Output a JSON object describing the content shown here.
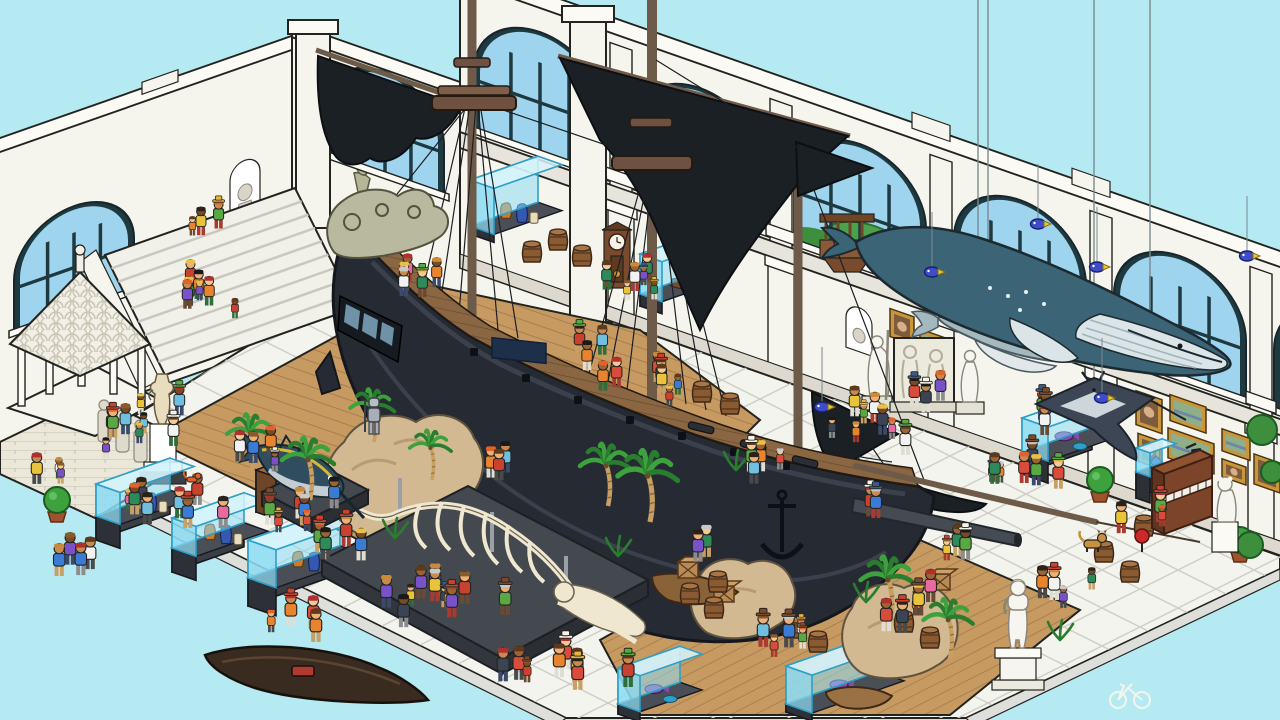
{
  "meta": {
    "app": "isometric-hidden-object-museum-scene",
    "description": "Isometric cartoon museum hall crowded with visitors: a large dark pirate galleon on a wooden floor, a hanging humpback whale with calf and manta ray, a whale skeleton, a mounted marlin, glass display vitrines, classical statues, a piano, palm trees and rocks.",
    "canvas": {
      "w": 1280,
      "h": 720
    }
  },
  "palette": {
    "sky": "#b5eaf3",
    "wall": "#f5f4ed",
    "wallShade": "#e7e5db",
    "wallLine": "#23231f",
    "frame": "#1e3a40",
    "glass": "#9fd4ee",
    "tile": "#f4f4ef",
    "tileLine": "#cdcdc4",
    "tileSkirt": "#dededa",
    "woodFloor": "#c79a62",
    "woodLine": "#a07748",
    "deck": "#8a6742",
    "deckLine": "#5f462d",
    "hull": "#262b33",
    "hullLight": "#3a414c",
    "hullDark": "#14171c",
    "sail": "#1b2025",
    "mast": "#6e5a49",
    "whale": "#3b6477",
    "whaleBelly": "#dbe4e6",
    "calf": "#a3b8bf",
    "bone": "#f0e7d1",
    "boneLine": "#6a614e",
    "rock": "#d2b992",
    "rockShade": "#b99a72",
    "palm": "#3da23d",
    "palmDark": "#2a7d2f",
    "trunk": "#c9a062",
    "caseGlass": "#8ddcf4",
    "caseEdge": "#2e9fc6",
    "caseBase": "#3a3e45",
    "gold": "#c9973a",
    "piano": "#7c4429",
    "statue": "#f6f5ef",
    "barrel": "#8a5a33",
    "barrelTop": "#a97547",
    "crate": "#b98a55"
  },
  "scene": {
    "objects": [
      "pirate-galleon",
      "humpback-whale-model",
      "whale-calf-model",
      "manta-ray-model",
      "whale-skeleton",
      "marlin-mount",
      "grand-staircase",
      "stone-pavilion",
      "display-vitrines",
      "aquarium-tanks",
      "gallery-paintings",
      "upright-piano",
      "david-statue",
      "classical-statues",
      "grandfather-clock",
      "suit-of-armor",
      "canoe",
      "rowboat",
      "palm-trees",
      "rocks",
      "visitors",
      "dog",
      "cat",
      "bicycle"
    ],
    "walls": {
      "right_windows": [
        {
          "x": 474,
          "bush": false
        },
        {
          "x": 634,
          "bush": false
        },
        {
          "x": 794,
          "bush": true
        },
        {
          "x": 954,
          "bush": true
        },
        {
          "x": 1114,
          "bush": false
        },
        {
          "x": 1274,
          "bush": false
        }
      ],
      "right_window_size": {
        "y": 48,
        "w": 132,
        "h": 122
      },
      "left_windows": [
        {
          "x": 14,
          "y": 232,
          "w": 120,
          "h": 106
        }
      ],
      "mid_windows": [
        {
          "x": 326,
          "y": 2,
          "w": 118,
          "h": 104
        }
      ],
      "pilasters_x": [
        610,
        770,
        930,
        1090,
        1250
      ],
      "paintings_right": [
        {
          "x": 1136,
          "y": 198,
          "w": 26,
          "h": 34,
          "k": "p"
        },
        {
          "x": 1170,
          "y": 190,
          "w": 36,
          "h": 26,
          "k": "l"
        },
        {
          "x": 1138,
          "y": 240,
          "w": 22,
          "h": 28,
          "k": "p"
        },
        {
          "x": 1168,
          "y": 224,
          "w": 46,
          "h": 30,
          "k": "l"
        },
        {
          "x": 1222,
          "y": 206,
          "w": 28,
          "h": 22,
          "k": "l"
        },
        {
          "x": 1222,
          "y": 236,
          "w": 24,
          "h": 18,
          "k": "p"
        },
        {
          "x": 1254,
          "y": 220,
          "w": 26,
          "h": 30,
          "k": "p"
        }
      ],
      "paintings_mid": [
        {
          "x": 890,
          "y": 202,
          "w": 24,
          "h": 28,
          "k": "p"
        },
        {
          "x": 920,
          "y": 212,
          "w": 32,
          "h": 20,
          "k": "l"
        }
      ],
      "niches_right": [
        {
          "x": 688,
          "y": 206
        },
        {
          "x": 846,
          "y": 212
        }
      ],
      "lanterns_right": [
        {
          "x": 698,
          "y": 222
        },
        {
          "x": 1186,
          "y": 238
        }
      ],
      "sconces_mid": [
        {
          "x": 354,
          "y": 114
        },
        {
          "x": 411,
          "y": 80
        }
      ]
    },
    "props": {
      "vitrines": [
        {
          "x": 96,
          "y": 540,
          "w": 74,
          "d": 24,
          "hb": 24,
          "hg": 32,
          "type": "artifacts"
        },
        {
          "x": 172,
          "y": 572,
          "w": 72,
          "d": 24,
          "hb": 24,
          "hg": 30,
          "type": "artifacts"
        },
        {
          "x": 248,
          "y": 606,
          "w": 92,
          "d": 28,
          "hb": 28,
          "hg": 38,
          "type": "artifacts"
        },
        {
          "x": 256,
          "y": 512,
          "w": 38,
          "d": 20,
          "hb": 42,
          "hg": 0,
          "type": "cabinet"
        },
        {
          "x": 618,
          "y": 714,
          "w": 62,
          "d": 22,
          "hb": 10,
          "hg": 36,
          "type": "fish"
        },
        {
          "x": 786,
          "y": 712,
          "w": 92,
          "d": 26,
          "hb": 8,
          "hg": 38,
          "type": "fish"
        },
        {
          "x": 1022,
          "y": 474,
          "w": 70,
          "d": 26,
          "hb": 22,
          "hg": 34,
          "type": "fish"
        },
        {
          "x": 1136,
          "y": 498,
          "w": 26,
          "d": 14,
          "hb": 26,
          "hg": 24,
          "type": "gem"
        },
        {
          "x": 640,
          "y": 306,
          "w": 64,
          "d": 22,
          "hb": 12,
          "hg": 40,
          "type": "ship"
        },
        {
          "x": 470,
          "y": 234,
          "w": 68,
          "d": 24,
          "hb": 8,
          "hg": 46,
          "type": "artifacts"
        }
      ],
      "barrels": [
        [
          532,
          262
        ],
        [
          558,
          250
        ],
        [
          582,
          266
        ],
        [
          702,
          402
        ],
        [
          730,
          414
        ],
        [
          690,
          604
        ],
        [
          714,
          618
        ],
        [
          718,
          592
        ],
        [
          1104,
          562
        ],
        [
          1130,
          582
        ],
        [
          1144,
          536
        ],
        [
          904,
          632
        ],
        [
          930,
          648
        ],
        [
          797,
          638
        ],
        [
          818,
          652
        ]
      ],
      "crates": [
        [
          688,
          578
        ],
        [
          724,
          602
        ],
        [
          940,
          590
        ]
      ],
      "palms": [
        [
          608,
          506,
          1.0
        ],
        [
          650,
          522,
          1.15
        ],
        [
          252,
          470,
          0.9
        ],
        [
          310,
          500,
          1.0
        ],
        [
          374,
          442,
          0.85
        ],
        [
          432,
          480,
          0.8
        ],
        [
          890,
          622,
          1.05
        ],
        [
          950,
          658,
          0.95
        ]
      ],
      "ferns": [
        [
          736,
          470
        ],
        [
          618,
          556
        ],
        [
          395,
          538
        ],
        [
          866,
          602
        ],
        [
          1060,
          640
        ]
      ],
      "topiaries": [
        [
          57,
          512
        ],
        [
          1100,
          492
        ],
        [
          1240,
          552
        ]
      ],
      "outdoor_bushes": [
        [
          1262,
          430,
          15
        ],
        [
          1272,
          472,
          11
        ],
        [
          1250,
          545,
          13
        ]
      ],
      "dock_posts": [
        [
          630,
          626
        ],
        [
          670,
          603
        ],
        [
          710,
          580
        ],
        [
          750,
          557
        ],
        [
          790,
          534
        ],
        [
          830,
          512
        ]
      ]
    },
    "hanging": {
      "fish": [
        [
          1038,
          224
        ],
        [
          932,
          272
        ],
        [
          1097,
          267
        ],
        [
          822,
          407
        ],
        [
          1247,
          256
        ],
        [
          1102,
          398
        ]
      ],
      "whale_wires_x": [
        988,
        1150,
        978,
        1094
      ]
    },
    "crowd": {
      "seed": 9,
      "clusters": [
        [
          196,
          300,
          7,
          55,
          26
        ],
        [
          214,
          228,
          4,
          40,
          14
        ],
        [
          124,
          436,
          9,
          68,
          26
        ],
        [
          148,
          522,
          8,
          78,
          22
        ],
        [
          86,
          572,
          4,
          40,
          16
        ],
        [
          298,
          516,
          7,
          52,
          20
        ],
        [
          336,
          558,
          5,
          40,
          16
        ],
        [
          428,
          610,
          11,
          92,
          26
        ],
        [
          556,
          682,
          8,
          78,
          20
        ],
        [
          300,
          640,
          4,
          50,
          18
        ],
        [
          638,
          292,
          6,
          52,
          16
        ],
        [
          648,
          388,
          7,
          66,
          22
        ],
        [
          420,
          287,
          5,
          38,
          14
        ],
        [
          586,
          362,
          3,
          30,
          12
        ],
        [
          756,
          478,
          4,
          38,
          14
        ],
        [
          876,
          430,
          13,
          105,
          42
        ],
        [
          1002,
          482,
          7,
          64,
          24
        ],
        [
          1048,
          424,
          5,
          44,
          16
        ],
        [
          1142,
          528,
          3,
          34,
          12
        ],
        [
          1062,
          600,
          4,
          44,
          16
        ],
        [
          918,
          612,
          6,
          55,
          22
        ],
        [
          772,
          652,
          5,
          48,
          18
        ],
        [
          250,
          468,
          5,
          44,
          16
        ],
        [
          62,
          486,
          3,
          30,
          12
        ],
        [
          868,
          520,
          2,
          26,
          10
        ],
        [
          960,
          560,
          3,
          30,
          12
        ],
        [
          700,
          560,
          2,
          24,
          10
        ],
        [
          520,
          476,
          3,
          34,
          12
        ]
      ],
      "skin": [
        "#f7c997",
        "#edb077",
        "#c98a50",
        "#9a6435",
        "#7a4a26"
      ],
      "hair": [
        "#2b2118",
        "#5d3a1e",
        "#8a5a2b",
        "#c98a3a",
        "#e9c04a",
        "#e2622b",
        "#b03030",
        "#c9c9c9",
        "#1a1a1a"
      ],
      "top": [
        "#d94b3b",
        "#e8832e",
        "#e9c43a",
        "#58a843",
        "#3a7bd5",
        "#7a52c8",
        "#e86aa0",
        "#f2f2f2",
        "#3b4455",
        "#6fc0e0",
        "#2e8a5a",
        "#c9412f"
      ],
      "bottom": [
        "#3b4a6b",
        "#6b4a33",
        "#8c8c8c",
        "#e0ddd3",
        "#a83a30",
        "#2f6e3a",
        "#4a4a4a",
        "#c9a063"
      ],
      "hat": [
        "#c9412f",
        "#e8b43a",
        "#7a4a2e",
        "#f6f4ea",
        "#3a5a8c",
        "#58a843"
      ]
    }
  }
}
